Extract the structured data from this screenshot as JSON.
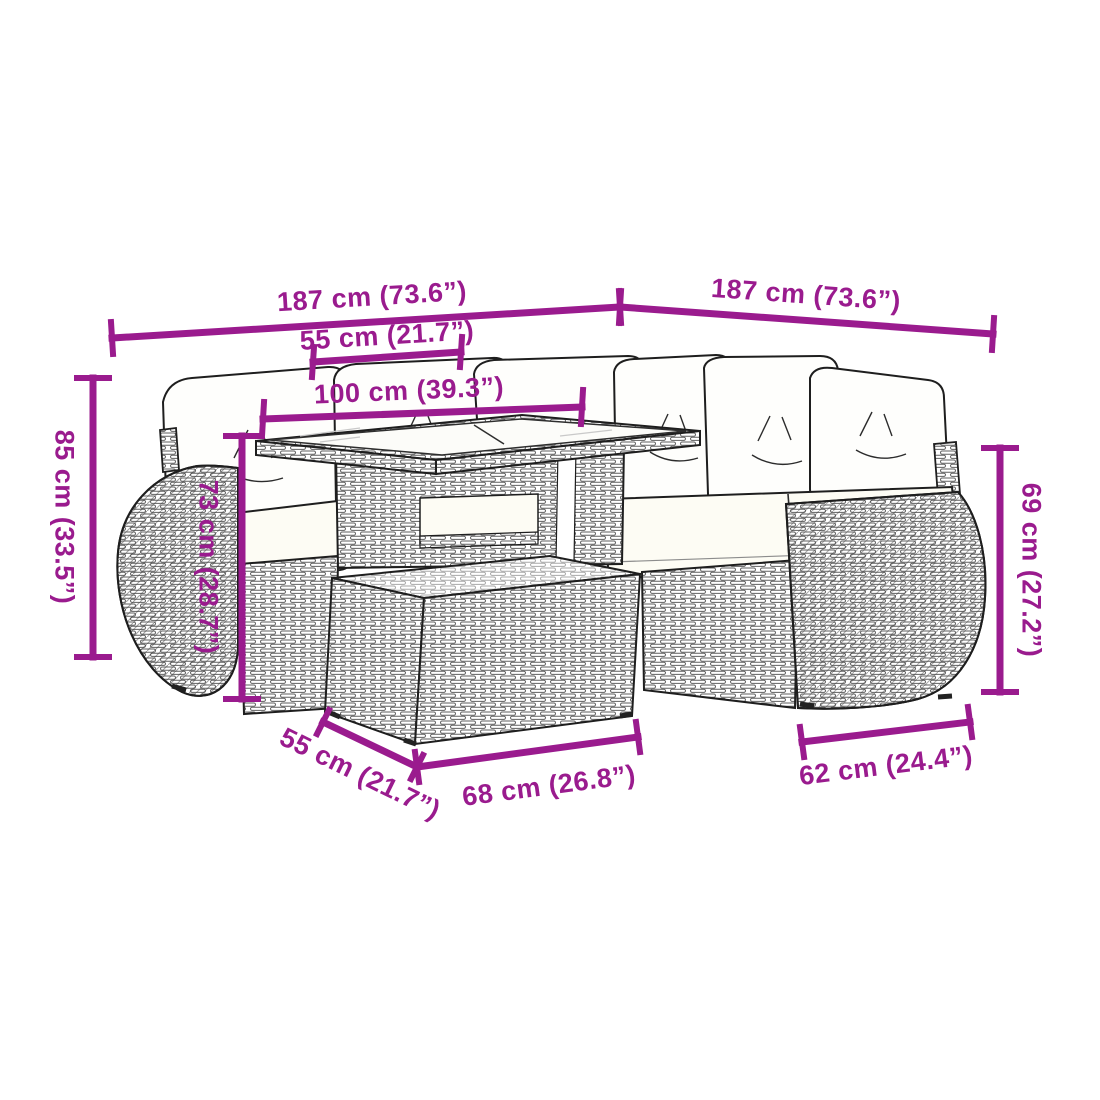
{
  "figure": {
    "description": "Black-and-white line drawing of a 6-piece poly rattan garden lounge set: corner sofa with white cushions, a table with slatted top, a footstool, and curved wicker armrests, annotated with magenta dimension lines",
    "accent_color": "#9A1B8E",
    "line_art_color": "#1e1e1e",
    "background_color": "#FFFFFF"
  },
  "dimension_labels": {
    "sofa_width_left": "187 cm (73.6”)",
    "sofa_width_right": "187 cm (73.6”)",
    "table_depth": "55 cm (21.7”)",
    "table_width": "100 cm (39.3”)",
    "back_height": "85 cm (33.5”)",
    "table_height": "73 cm (28.7”)",
    "armrest_height": "69 cm (27.2”)",
    "stool_depth": "55 cm (21.7”)",
    "stool_width": "68 cm (26.8”)",
    "seat_width": "62 cm (24.4”)"
  }
}
